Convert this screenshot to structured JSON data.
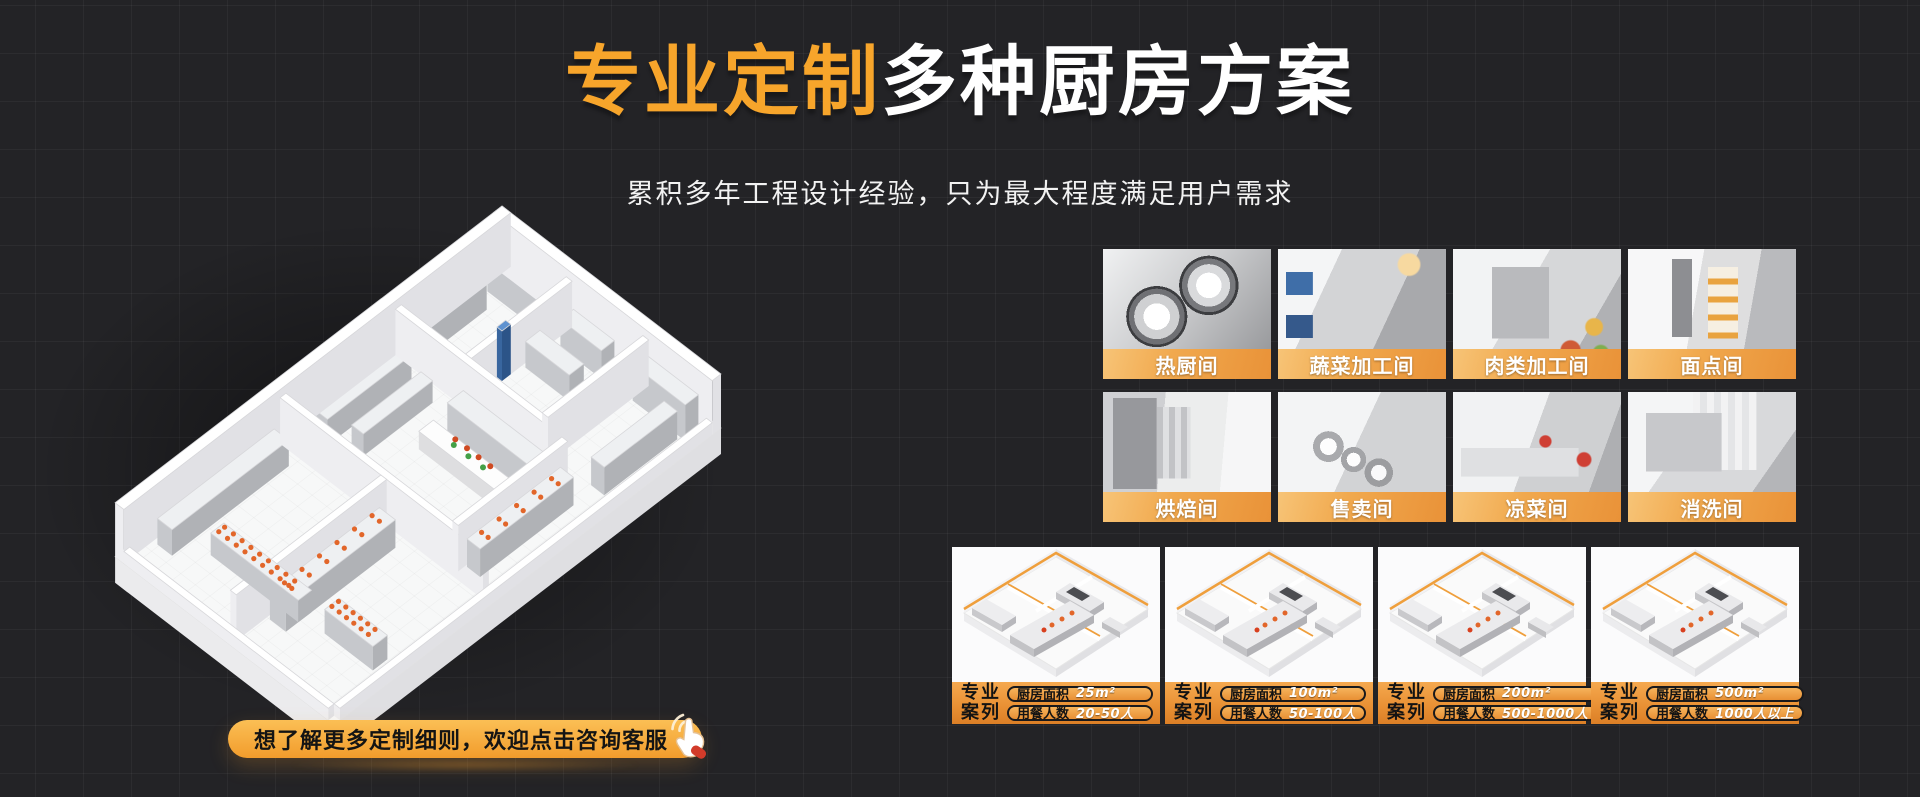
{
  "banner": {
    "title": {
      "highlight": "专业定制",
      "rest": "多种厨房方案"
    },
    "subtitle": "累积多年工程设计经验，只为最大程度满足用户需求",
    "cta": {
      "label": "想了解更多定制细则，欢迎点击咨询客服",
      "icon": "click-hand-icon"
    }
  },
  "rooms": [
    {
      "label": "热厨间"
    },
    {
      "label": "蔬菜加工间"
    },
    {
      "label": "肉类加工间"
    },
    {
      "label": "面点间"
    },
    {
      "label": "烘焙间"
    },
    {
      "label": "售卖间"
    },
    {
      "label": "凉菜间"
    },
    {
      "label": "消洗间"
    }
  ],
  "cases": {
    "tag": {
      "line1": "专业",
      "line2": "案列"
    },
    "fields": {
      "area": "厨房面积",
      "diners": "用餐人数"
    },
    "items": [
      {
        "area": "25m²",
        "diners": "20-50人"
      },
      {
        "area": "100m²",
        "diners": "50-100人"
      },
      {
        "area": "200m²",
        "diners": "500-1000人"
      },
      {
        "area": "500m²",
        "diners": "1000人以上"
      }
    ]
  },
  "colors": {
    "accent": "#F7A52B",
    "label_bar": "#EE9C41",
    "background": "#232326"
  }
}
